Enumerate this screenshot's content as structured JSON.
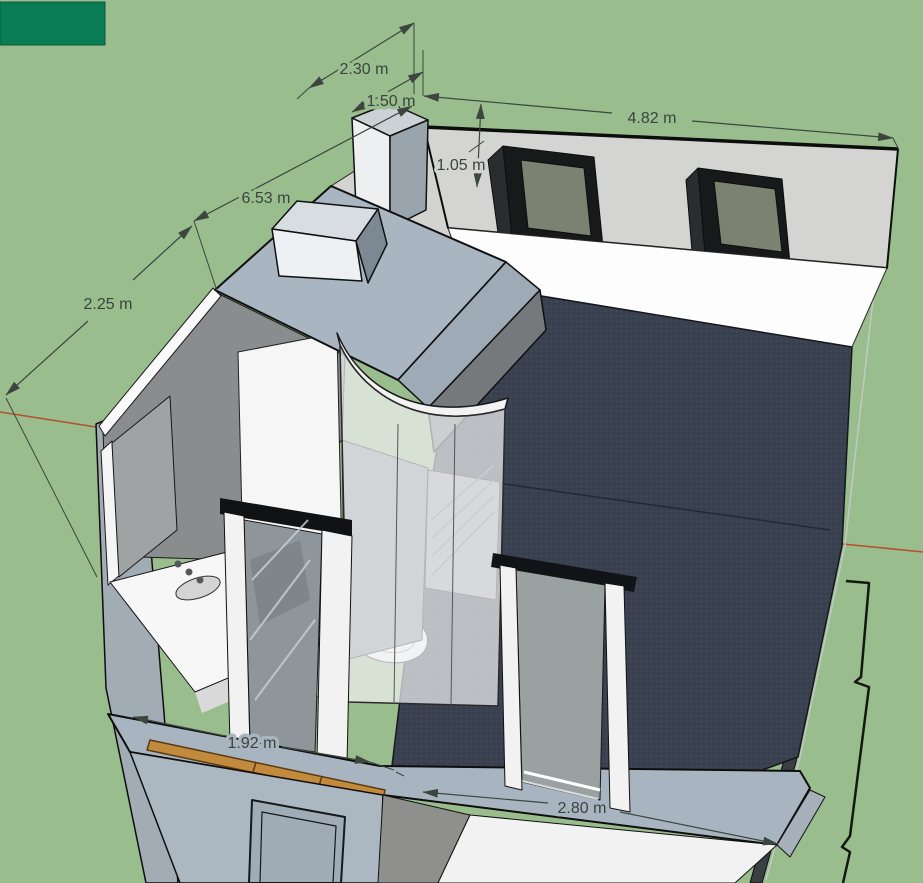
{
  "scene": {
    "type": "3d-architectural-model-viewport",
    "content": "Cutaway 3D model of a room with a prefabricated bathroom pod, two exterior windows on the back wall, dark carpet floor, section-cut walls and a rooftop shaft box"
  },
  "viewport": {
    "width": 923,
    "height": 883
  },
  "corner_tab": {
    "color": "#097B55"
  },
  "palette": {
    "background": "#9ABD8E",
    "back_wall": "#D4D4D2",
    "niche_wall": "#D3D3D1",
    "carpet_floor": "#3A4150",
    "steel_blue_walls": "#A8B5C0",
    "pod_roof": "#A9B6C1",
    "pod_gray": "#8A8D8E",
    "window_glass_olive": "#7B8271",
    "wood_strip": "#C18A3D",
    "axis_red": "#B5502F",
    "dimension_color": "#3C463F",
    "white_cut": "#FAFAFA"
  },
  "dimensions": [
    {
      "label": "2.30 m",
      "value": 2.3,
      "unit": "m"
    },
    {
      "label": "1.50 m",
      "value": 1.5,
      "unit": "m"
    },
    {
      "label": "4.82 m",
      "value": 4.82,
      "unit": "m"
    },
    {
      "label": "1.05 m",
      "value": 1.05,
      "unit": "m"
    },
    {
      "label": "6.53 m",
      "value": 6.53,
      "unit": "m"
    },
    {
      "label": "2.25 m",
      "value": 2.25,
      "unit": "m"
    },
    {
      "label": "1.92 m",
      "value": 1.92,
      "unit": "m"
    },
    {
      "label": "2.80 m",
      "value": 2.8,
      "unit": "m"
    }
  ]
}
